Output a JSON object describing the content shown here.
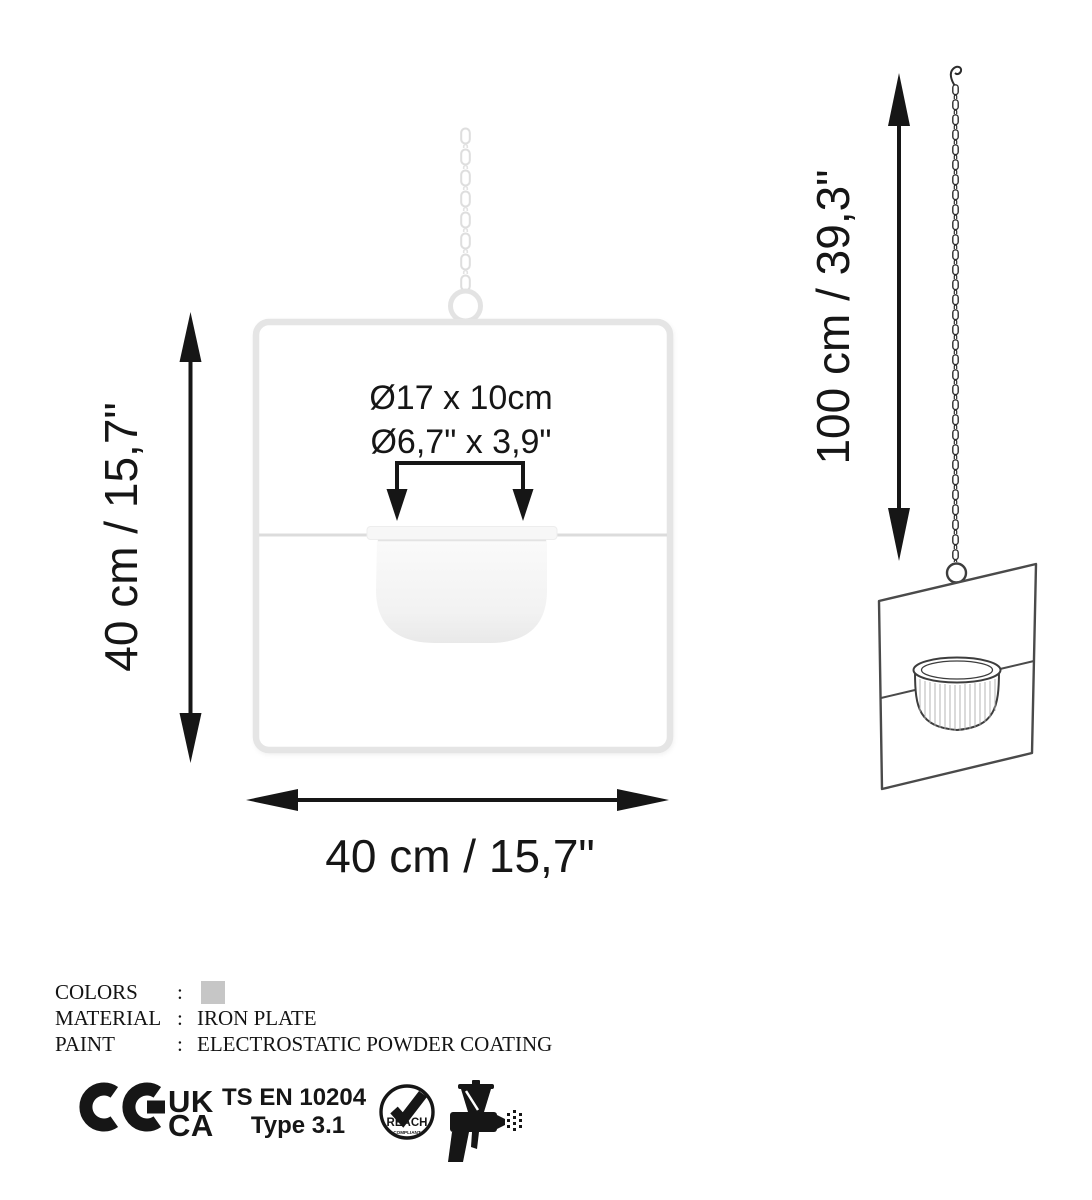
{
  "front_view": {
    "pot_dimension_metric": "Ø17 x 10cm",
    "pot_dimension_imperial": "Ø6,7\" x 3,9\"",
    "height_label": "40 cm / 15,7\"",
    "width_label": "40 cm / 15,7\""
  },
  "side_view": {
    "chain_length_label": "100 cm / 39,3\""
  },
  "specs": {
    "colors": {
      "label": "COLORS",
      "separator": ":",
      "swatch_color": "#c6c6c6"
    },
    "material": {
      "label": "MATERIAL",
      "separator": ":",
      "value": "IRON PLATE"
    },
    "paint": {
      "label": "PAINT",
      "separator": ":",
      "value": "ELECTROSTATIC POWDER COATING"
    }
  },
  "certifications": {
    "ukca": {
      "top": "UK",
      "bottom": "CA"
    },
    "standard": {
      "name": "TS EN 10204",
      "type": "Type 3.1"
    },
    "reach": {
      "title": "REACH",
      "subtitle": "COMPLIANT"
    }
  },
  "colors": {
    "line_art": "#1a1a1a",
    "frame_light_gray": "#e5e5e5",
    "swatch_gray": "#c6c6c6"
  }
}
